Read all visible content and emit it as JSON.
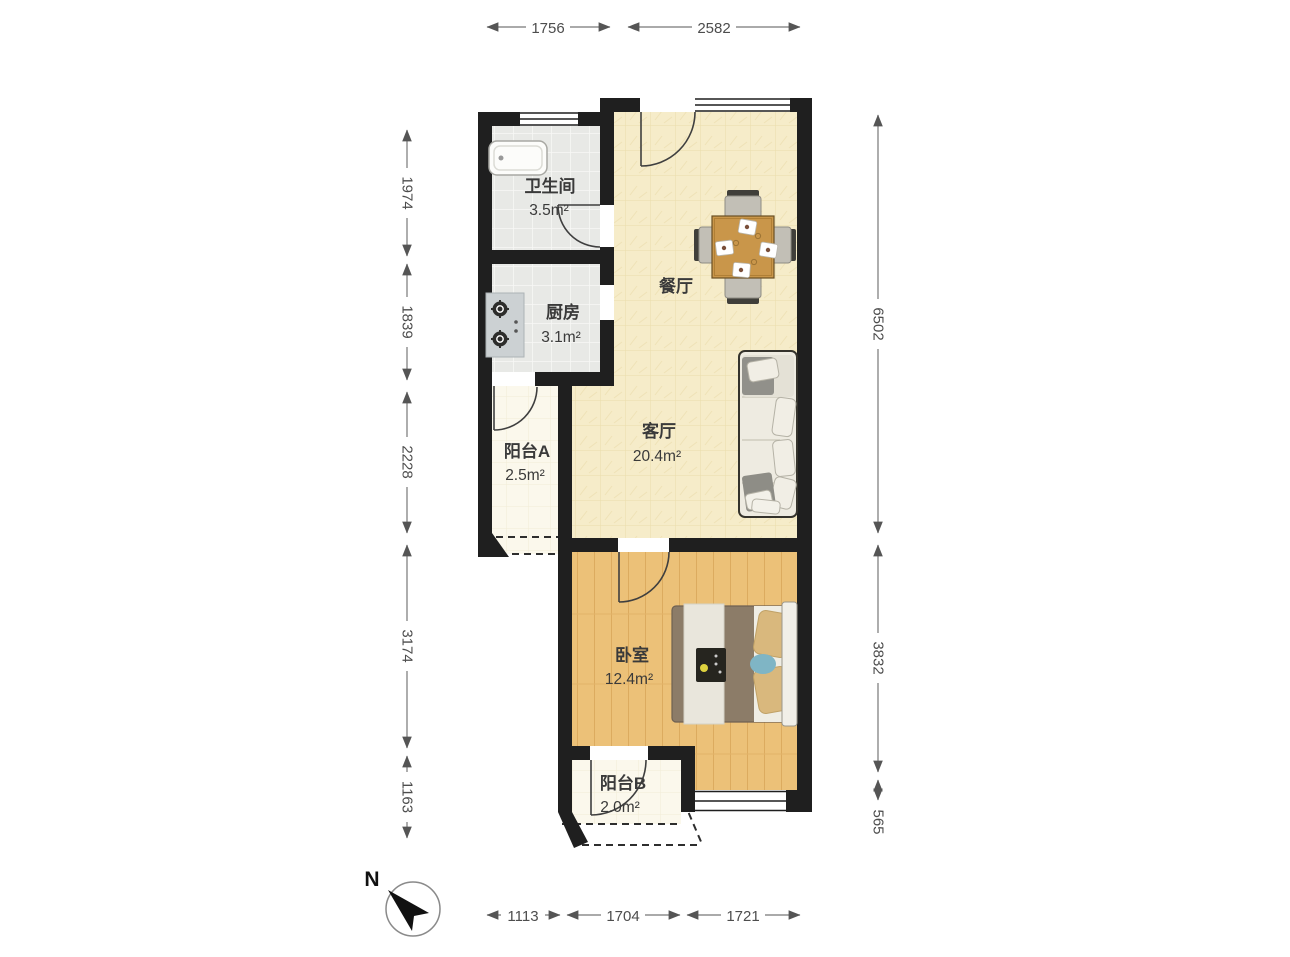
{
  "title": "户型图",
  "compass": {
    "label": "N"
  },
  "rooms": {
    "bathroom": {
      "name": "卫生间",
      "area": "3.5m²"
    },
    "kitchen": {
      "name": "厨房",
      "area": "3.1m²"
    },
    "dining": {
      "name": "餐厅"
    },
    "living": {
      "name": "客厅",
      "area": "20.4m²"
    },
    "balcony_a": {
      "name": "阳台A",
      "area": "2.5m²"
    },
    "bedroom": {
      "name": "卧室",
      "area": "12.4m²"
    },
    "balcony_b": {
      "name": "阳台B",
      "area": "2.0m²"
    }
  },
  "dimensions": {
    "top": [
      {
        "label": "1756"
      },
      {
        "label": "2582"
      }
    ],
    "left": [
      {
        "label": "1974"
      },
      {
        "label": "1839"
      },
      {
        "label": "2228"
      },
      {
        "label": "3174"
      },
      {
        "label": "1163"
      }
    ],
    "right": [
      {
        "label": "6502"
      },
      {
        "label": "3832"
      },
      {
        "label": "565"
      }
    ],
    "bottom": [
      {
        "label": "1113"
      },
      {
        "label": "1704"
      },
      {
        "label": "1721"
      }
    ]
  },
  "colors": {
    "wall": "#1f1f1f",
    "living_floor": "#f6ecc9",
    "tile_floor": "#e8e9e6",
    "wood_floor": "#ecc178",
    "balcony_floor": "#fbf8ec",
    "table_wood": "#c9964a",
    "bed_blanket": "#8c7c68",
    "pillow_tan": "#d9b87d",
    "accent_blue": "#7fb5c5"
  }
}
